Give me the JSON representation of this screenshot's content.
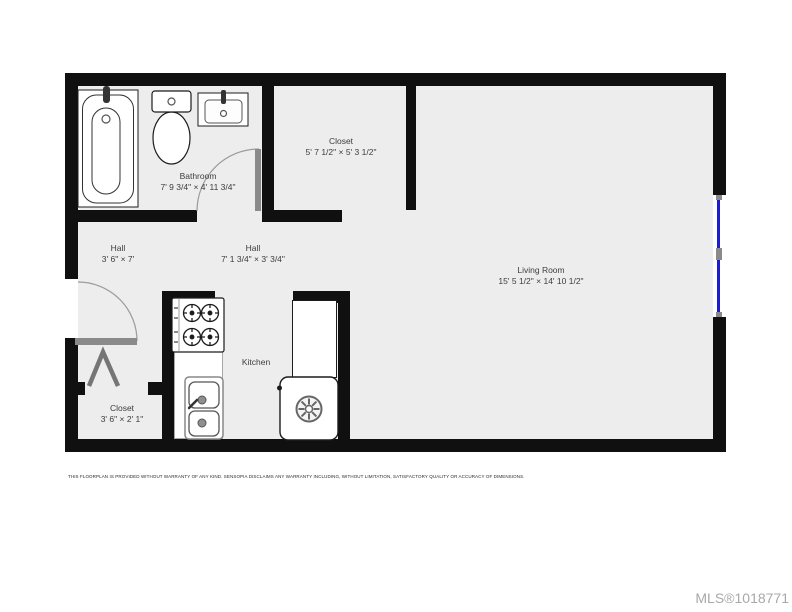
{
  "rooms": {
    "bathroom": {
      "name": "Bathroom",
      "dims": "7' 9 3/4\" × 4' 11 3/4\""
    },
    "closet_top": {
      "name": "Closet",
      "dims": "5' 7 1/2\" × 5' 3 1/2\""
    },
    "hall_left": {
      "name": "Hall",
      "dims": "3' 6\" × 7'"
    },
    "hall_mid": {
      "name": "Hall",
      "dims": "7' 1 3/4\" × 3' 3/4\""
    },
    "living_room": {
      "name": "Living Room",
      "dims": "15' 5 1/2\" × 14' 10 1/2\""
    },
    "kitchen": {
      "name": "Kitchen",
      "dims": ""
    },
    "closet_bottom": {
      "name": "Closet",
      "dims": "3' 6\" × 2' 1\""
    }
  },
  "footer": {
    "disclaimer": "THIS FLOORPLAN IS PROVIDED WITHOUT WARRANTY OF ANY KIND. SENSOPIA DISCLAIMS ANY WARRANTY INCLUDING, WITHOUT LIMITATION, SATISFACTORY QUALITY OR ACCURACY OF DIMENSIONS.",
    "mls": "MLS®1018771"
  },
  "colors": {
    "wall": "#101010",
    "floor": "#ededed",
    "window_glass": "#1d1dcb",
    "door": "#8a8a8a",
    "mls_text": "#a8a8a8"
  }
}
